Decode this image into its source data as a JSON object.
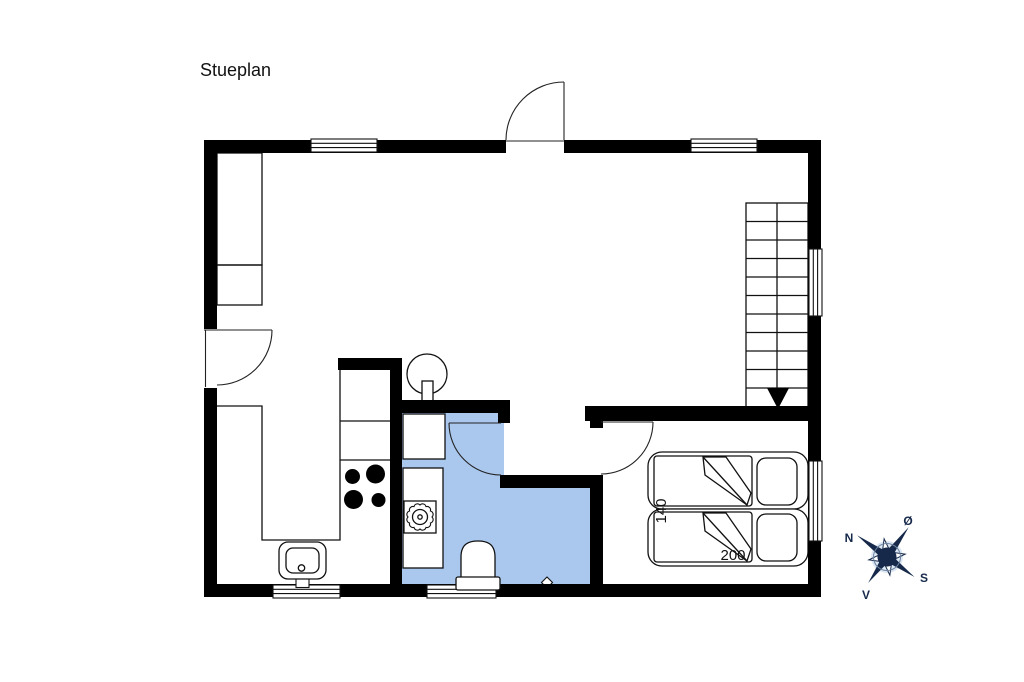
{
  "title": "Stueplan",
  "plan": {
    "colors": {
      "wall": "#000000",
      "bathroom_fill": "#aac8ee",
      "line": "#111111",
      "compass_navy": "#16294a",
      "compass_halo": "#dce7f3"
    },
    "rooms": [
      "living-room",
      "kitchen",
      "bathroom",
      "bedroom",
      "hall"
    ],
    "fixtures": [
      "wardrobe-cabinets",
      "wood-stove",
      "kitchen-counter",
      "stove-burners",
      "kitchen-sink",
      "bathroom-cabinet",
      "washer-shower-unit",
      "toilet",
      "floor-drain",
      "double-bed",
      "pillows",
      "stairs-down",
      "windows",
      "doors"
    ],
    "bed": {
      "width_label": "140",
      "length_label": "200"
    },
    "stairs": {
      "direction": "down-arrow"
    },
    "compass": {
      "north_label": "N",
      "east_label": "Ø",
      "south_label": "S",
      "west_label": "V"
    }
  }
}
